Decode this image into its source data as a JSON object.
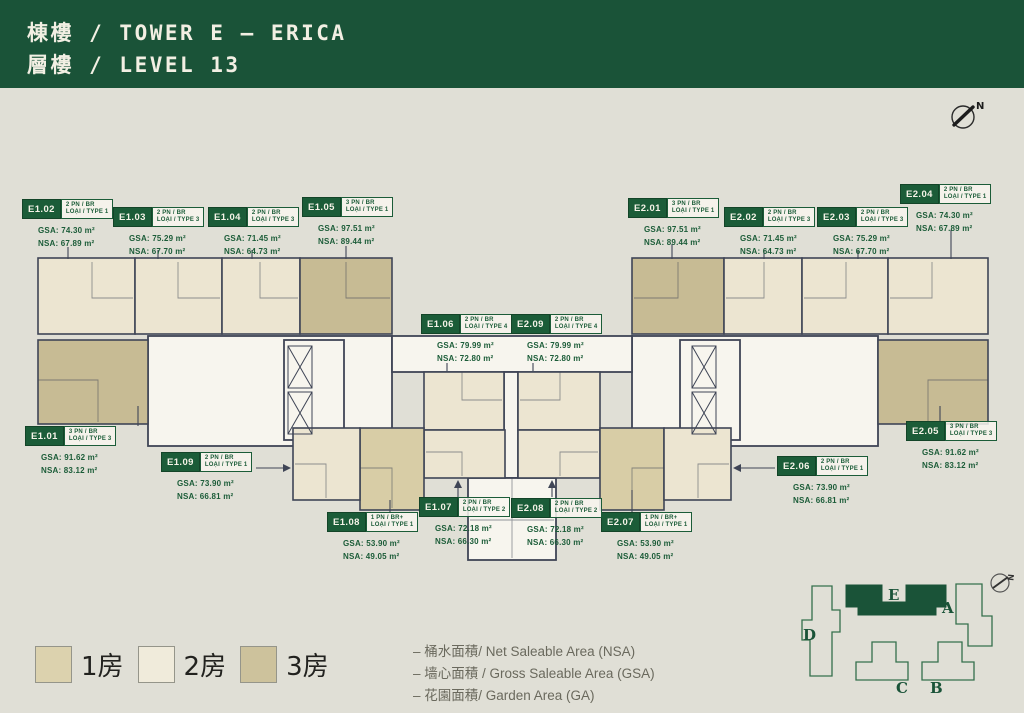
{
  "header": {
    "line1": "棟樓 / TOWER E – ERICA",
    "line2": "層樓 / LEVEL 13"
  },
  "compass": {
    "n": "N"
  },
  "units": [
    {
      "code": "E1.01",
      "bed": "3 PN / BR",
      "type": "LOẠI / TYPE 3",
      "gsa": "GSA: 91.62 m²",
      "nsa": "NSA: 83.12 m²"
    },
    {
      "code": "E1.02",
      "bed": "2 PN / BR",
      "type": "LOẠI / TYPE 1",
      "gsa": "GSA: 74.30 m²",
      "nsa": "NSA: 67.89 m²"
    },
    {
      "code": "E1.03",
      "bed": "2 PN / BR",
      "type": "LOẠI / TYPE 3",
      "gsa": "GSA: 75.29 m²",
      "nsa": "NSA: 67.70 m²"
    },
    {
      "code": "E1.04",
      "bed": "2 PN / BR",
      "type": "LOẠI / TYPE 3",
      "gsa": "GSA: 71.45 m²",
      "nsa": "NSA: 64.73 m²"
    },
    {
      "code": "E1.05",
      "bed": "3 PN / BR",
      "type": "LOẠI / TYPE 1",
      "gsa": "GSA: 97.51 m²",
      "nsa": "NSA: 89.44 m²"
    },
    {
      "code": "E1.06",
      "bed": "2 PN / BR",
      "type": "LOẠI / TYPE 4",
      "gsa": "GSA: 79.99 m²",
      "nsa": "NSA: 72.80 m²"
    },
    {
      "code": "E1.07",
      "bed": "2 PN / BR",
      "type": "LOẠI / TYPE 2",
      "gsa": "GSA: 72.18 m²",
      "nsa": "NSA: 66.30 m²"
    },
    {
      "code": "E1.08",
      "bed": "1 PN / BR+",
      "type": "LOẠI / TYPE 1",
      "gsa": "GSA: 53.90 m²",
      "nsa": "NSA: 49.05 m²"
    },
    {
      "code": "E1.09",
      "bed": "2 PN / BR",
      "type": "LOẠI / TYPE 1",
      "gsa": "GSA: 73.90 m²",
      "nsa": "NSA: 66.81 m²"
    },
    {
      "code": "E2.01",
      "bed": "3 PN / BR",
      "type": "LOẠI / TYPE 1",
      "gsa": "GSA: 97.51 m²",
      "nsa": "NSA: 89.44 m²"
    },
    {
      "code": "E2.02",
      "bed": "2 PN / BR",
      "type": "LOẠI / TYPE 3",
      "gsa": "GSA: 71.45 m²",
      "nsa": "NSA: 64.73 m²"
    },
    {
      "code": "E2.03",
      "bed": "2 PN / BR",
      "type": "LOẠI / TYPE 3",
      "gsa": "GSA: 75.29 m²",
      "nsa": "NSA: 67.70 m²"
    },
    {
      "code": "E2.04",
      "bed": "2 PN / BR",
      "type": "LOẠI / TYPE 1",
      "gsa": "GSA: 74.30 m²",
      "nsa": "NSA: 67.89 m²"
    },
    {
      "code": "E2.05",
      "bed": "3 PN / BR",
      "type": "LOẠI / TYPE 3",
      "gsa": "GSA: 91.62 m²",
      "nsa": "NSA: 83.12 m²"
    },
    {
      "code": "E2.06",
      "bed": "2 PN / BR",
      "type": "LOẠI / TYPE 1",
      "gsa": "GSA: 73.90 m²",
      "nsa": "NSA: 66.81 m²"
    },
    {
      "code": "E2.07",
      "bed": "1 PN / BR+",
      "type": "LOẠI / TYPE 1",
      "gsa": "GSA: 53.90 m²",
      "nsa": "NSA: 49.05 m²"
    },
    {
      "code": "E2.08",
      "bed": "2 PN / BR",
      "type": "LOẠI / TYPE 2",
      "gsa": "GSA: 72.18 m²",
      "nsa": "NSA: 66.30 m²"
    },
    {
      "code": "E2.09",
      "bed": "2 PN / BR",
      "type": "LOẠI / TYPE 4",
      "gsa": "GSA: 79.99 m²",
      "nsa": "NSA: 72.80 m²"
    }
  ],
  "legend": {
    "items": [
      {
        "label": "1房",
        "color": "#dcd2ae"
      },
      {
        "label": "2房",
        "color": "#f0ebdb"
      },
      {
        "label": "3房",
        "color": "#cdc29c"
      }
    ]
  },
  "notes": {
    "lines": [
      "–  桶水面積/ Net Saleable Area (NSA)",
      "–  墙心面積 / Gross Saleable Area (GSA)",
      "–  花園面積/ Garden Area (GA)"
    ]
  },
  "minimap": {
    "towers": {
      "d": "D",
      "e": "E",
      "a": "A",
      "c": "C",
      "b": "B"
    },
    "compass_n": "N"
  },
  "colors": {
    "header_green": "#1a5338",
    "label_green": "#1b5c38",
    "wall": "#3f4556",
    "background": "#e0dfd6",
    "unit_1br": "#d8cda6",
    "unit_2br": "#ece5d1",
    "unit_3br": "#c7bb94"
  }
}
